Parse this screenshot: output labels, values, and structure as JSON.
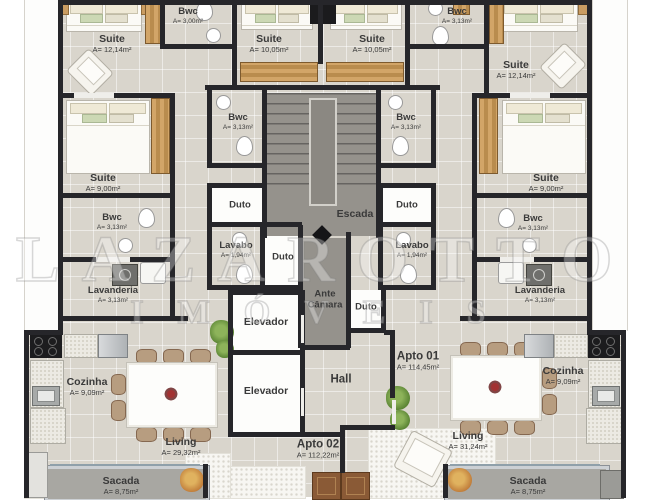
{
  "watermark": {
    "line1": "LAZAROTTO",
    "line2": "IMÓVEIS"
  },
  "colors": {
    "floor": "#d9d5cc",
    "wall": "#26262a",
    "stair": "#95928c",
    "sacada": "#a8a7a2"
  },
  "rooms": {
    "suite_tl": {
      "line1": "Suite",
      "line2": "A= 12,14m²"
    },
    "bwc_tl": {
      "line1": "Bwc",
      "line2": "A= 3,00m²"
    },
    "suite_tcl": {
      "line1": "Suite",
      "line2": "A= 10,05m²"
    },
    "suite_tcr": {
      "line1": "Suite",
      "line2": "A= 10,05m²"
    },
    "bwc_tr": {
      "line1": "Bwc",
      "line2": "A= 3,13m²"
    },
    "suite_tr": {
      "line1": "Suite",
      "line2": "A= 12,14m²"
    },
    "bwc_inner_l": {
      "line1": "Bwc",
      "line2": "A= 3,13m²"
    },
    "bwc_inner_r": {
      "line1": "Bwc",
      "line2": "A= 3,13m²"
    },
    "suite_ml": {
      "line1": "Suite",
      "line2": "A= 9,00m²"
    },
    "suite_mr": {
      "line1": "Suite",
      "line2": "A= 9,00m²"
    },
    "bwc_outer_l": {
      "line1": "Bwc",
      "line2": "A= 3,13m²"
    },
    "bwc_outer_r": {
      "line1": "Bwc",
      "line2": "A= 3,13m²"
    },
    "duto_l": {
      "line1": "Duto"
    },
    "escada": {
      "line1": "Escada"
    },
    "duto_r": {
      "line1": "Duto"
    },
    "lavabo_l": {
      "line1": "Lavabo",
      "line2": "A= 1,94m²"
    },
    "duto_cl": {
      "line1": "Duto"
    },
    "lavabo_r": {
      "line1": "Lavabo",
      "line2": "A= 1,94m²"
    },
    "lavanderia_l": {
      "line1": "Lavanderia",
      "line2": "A= 3,13m²"
    },
    "lavanderia_r": {
      "line1": "Lavanderia",
      "line2": "A= 3,13m²"
    },
    "ante_camara": {
      "line1": "Ante",
      "line2": "Câmara"
    },
    "duto_cr": {
      "line1": "Duto"
    },
    "elevador_1": {
      "line1": "Elevador"
    },
    "elevador_2": {
      "line1": "Elevador"
    },
    "hall": {
      "line1": "Hall"
    },
    "apto_01": {
      "line1": "Apto 01",
      "line2": "A= 114,45m²"
    },
    "apto_02": {
      "line1": "Apto 02",
      "line2": "A= 112,22m²"
    },
    "cozinha_l": {
      "line1": "Cozinha",
      "line2": "A= 9,09m²"
    },
    "cozinha_r": {
      "line1": "Cozinha",
      "line2": "A= 9,09m²"
    },
    "living_l": {
      "line1": "Living",
      "line2": "A= 29,32m²"
    },
    "living_r": {
      "line1": "Living",
      "line2": "A= 31,24m²"
    },
    "sacada_l": {
      "line1": "Sacada",
      "line2": "A= 8,75m²"
    },
    "sacada_r": {
      "line1": "Sacada",
      "line2": "A= 8,75m²"
    }
  }
}
